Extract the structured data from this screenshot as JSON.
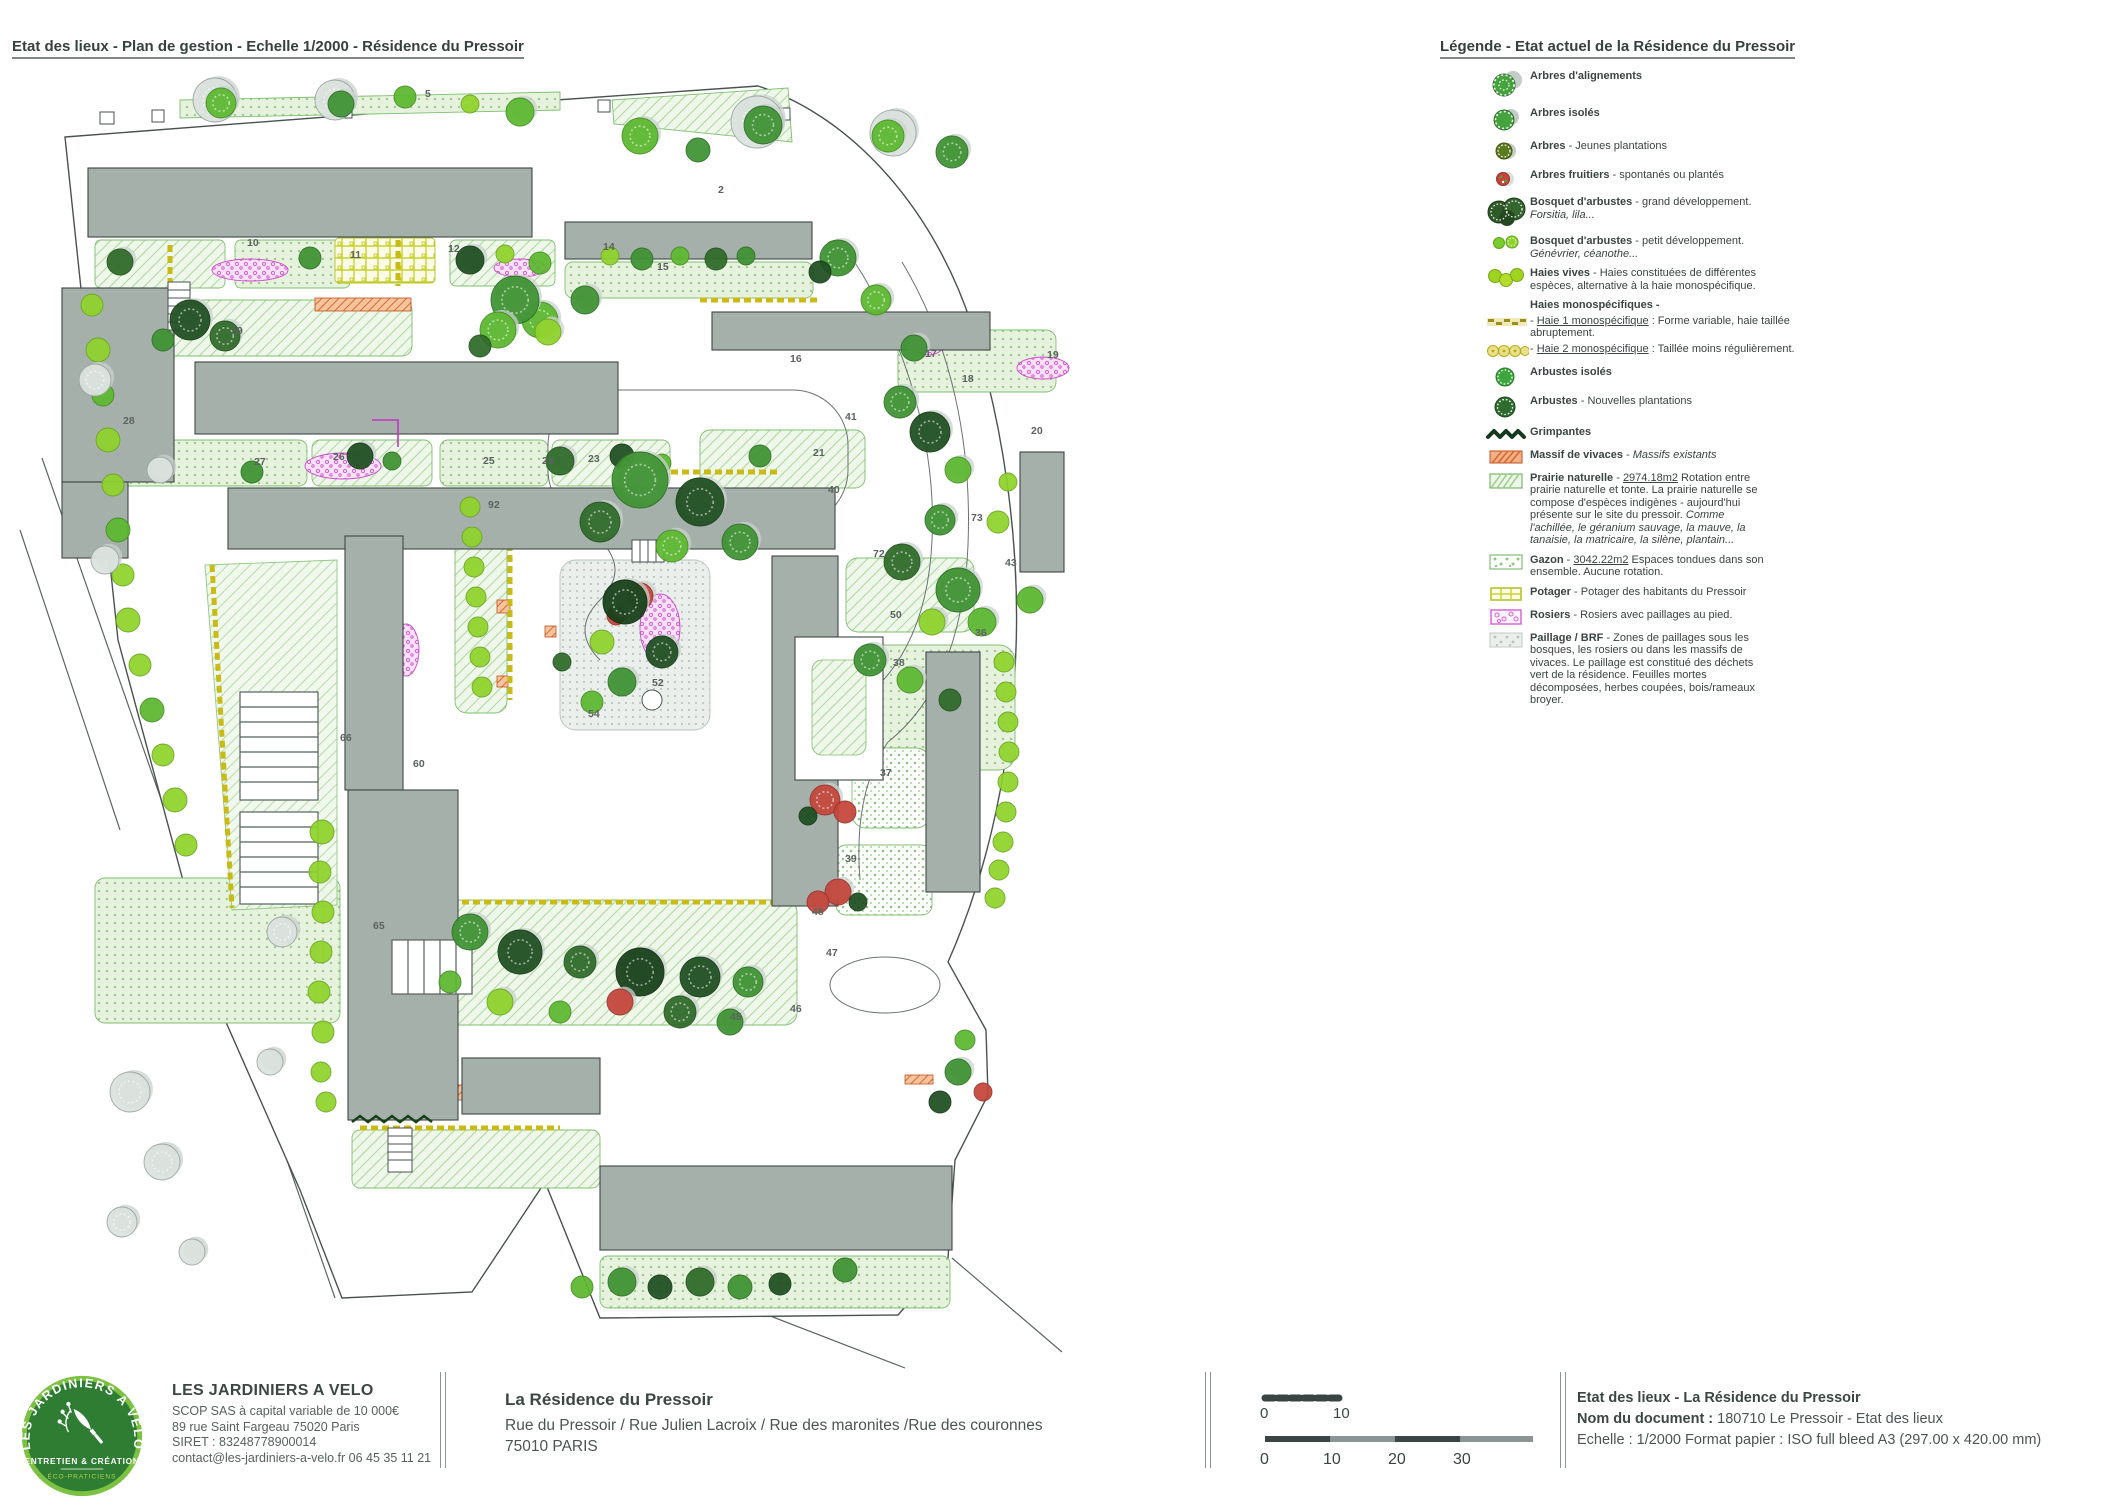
{
  "header": {
    "plan_title": "Etat des lieux - Plan de gestion - Echelle 1/2000 - Résidence du Pressoir",
    "legend_title": "Légende - Etat actuel de la Résidence du Pressoir"
  },
  "legend": {
    "items": [
      {
        "icon": "tree-alignment-icon",
        "lines": [
          [
            {
              "t": "Arbres d'alignements",
              "b": 1
            }
          ]
        ]
      },
      {
        "icon": "tree-isolated-icon",
        "lines": [
          [
            {
              "t": "Arbres isolés",
              "b": 1
            }
          ]
        ]
      },
      {
        "icon": "tree-young-icon",
        "lines": [
          [
            {
              "t": "Arbres",
              "b": 1
            },
            {
              "t": " - Jeunes plantations"
            }
          ]
        ]
      },
      {
        "icon": "tree-fruit-icon",
        "lines": [
          [
            {
              "t": "Arbres fruitiers",
              "b": 1
            },
            {
              "t": " - spontanés ou plantés"
            }
          ]
        ]
      },
      {
        "icon": "shrub-large-icon",
        "lines": [
          [
            {
              "t": "Bosquet d'arbustes",
              "b": 1
            },
            {
              "t": " - grand développement."
            }
          ],
          [
            {
              "t": "Forsitia, lila...",
              "i": 1
            }
          ]
        ]
      },
      {
        "icon": "shrub-small-icon",
        "lines": [
          [
            {
              "t": "Bosquet d'arbustes",
              "b": 1
            },
            {
              "t": " - petit développement."
            }
          ],
          [
            {
              "t": "Génévrier, céanothe...",
              "i": 1
            }
          ]
        ]
      },
      {
        "icon": "hedge-mixed-icon",
        "lines": [
          [
            {
              "t": "Haies vives",
              "b": 1
            },
            {
              "t": " - Haies constituées de différentes"
            }
          ],
          [
            {
              "t": "espèces, alternative à la haie monospécifique."
            }
          ]
        ]
      },
      {
        "icon": null,
        "tight": 1,
        "lines": [
          [
            {
              "t": "Haies monospécifiques -",
              "b": 1
            }
          ]
        ]
      },
      {
        "icon": "hedge-mono1-icon",
        "tight": 1,
        "lines": [
          [
            {
              "t": "- "
            },
            {
              "t": "Haie 1 monospécifique",
              "u": 1
            },
            {
              "t": " : Forme variable, haie taillée"
            }
          ],
          [
            {
              "t": "abruptement."
            }
          ]
        ]
      },
      {
        "icon": "hedge-mono2-icon",
        "lines": [
          [
            {
              "t": "- "
            },
            {
              "t": "Haie 2 monospécifique",
              "u": 1
            },
            {
              "t": " : Taillée moins régulièrement."
            }
          ]
        ]
      },
      {
        "icon": "arbuste-isolated-icon",
        "lines": [
          [
            {
              "t": "Arbustes isolés",
              "b": 1
            }
          ]
        ]
      },
      {
        "icon": "arbuste-new-icon",
        "lines": [
          [
            {
              "t": "Arbustes",
              "b": 1
            },
            {
              "t": " - Nouvelles plantations"
            }
          ]
        ]
      },
      {
        "icon": "climber-icon",
        "lines": [
          [
            {
              "t": "Grimpantes",
              "b": 1
            }
          ]
        ]
      },
      {
        "icon": "perennial-icon",
        "lines": [
          [
            {
              "t": "Massif de vivaces",
              "b": 1
            },
            {
              "t": " - "
            },
            {
              "t": "Massifs existants",
              "i": 1
            }
          ]
        ]
      },
      {
        "icon": "prairie-icon",
        "lines": [
          [
            {
              "t": "Prairie naturelle",
              "b": 1
            },
            {
              "t": " - "
            },
            {
              "t": "2974.18m2",
              "u": 1
            },
            {
              "t": " Rotation entre"
            }
          ],
          [
            {
              "t": "prairie naturelle et tonte. La prairie naturelle se"
            }
          ],
          [
            {
              "t": "compose d'espèces indigènes - aujourd'hui"
            }
          ],
          [
            {
              "t": "présente sur le site du pressoir. "
            },
            {
              "t": "Comme",
              "i": 1
            }
          ],
          [
            {
              "t": "l'achillée, le géranium sauvage, la mauve, la",
              "i": 1
            }
          ],
          [
            {
              "t": "tanaisie, la matricaire, la silène, plantain...",
              "i": 1
            }
          ]
        ]
      },
      {
        "icon": "gazon-icon",
        "lines": [
          [
            {
              "t": "Gazon",
              "b": 1
            },
            {
              "t": " - "
            },
            {
              "t": "3042.22m2",
              "u": 1
            },
            {
              "t": " Espaces tondues dans son"
            }
          ],
          [
            {
              "t": "ensemble. Aucune rotation."
            }
          ]
        ]
      },
      {
        "icon": "potager-icon",
        "lines": [
          [
            {
              "t": "Potager",
              "b": 1
            },
            {
              "t": " - Potager des habitants du Pressoir"
            }
          ]
        ]
      },
      {
        "icon": "rosiers-icon",
        "lines": [
          [
            {
              "t": "Rosiers",
              "b": 1
            },
            {
              "t": " - Rosiers avec paillages au pied."
            }
          ]
        ]
      },
      {
        "icon": "paillage-icon",
        "lines": [
          [
            {
              "t": "Paillage / BRF",
              "b": 1
            },
            {
              "t": " - Zones de paillages sous les"
            }
          ],
          [
            {
              "t": "bosques, les rosiers ou dans les massifs de"
            }
          ],
          [
            {
              "t": "vivaces. Le paillage est  constitué des déchets"
            }
          ],
          [
            {
              "t": "vert de la résidence. Feuilles mortes"
            }
          ],
          [
            {
              "t": "décomposées, herbes coupées, bois/rameaux"
            }
          ],
          [
            {
              "t": "broyer."
            }
          ]
        ]
      }
    ]
  },
  "map": {
    "zone_labels": [
      {
        "n": "5",
        "x": 425,
        "y": 97
      },
      {
        "n": "2",
        "x": 718,
        "y": 193
      },
      {
        "n": "92",
        "x": 488,
        "y": 508
      },
      {
        "n": "10",
        "x": 247,
        "y": 246
      },
      {
        "n": "11",
        "x": 350,
        "y": 258
      },
      {
        "n": "12",
        "x": 448,
        "y": 252
      },
      {
        "n": "14",
        "x": 603,
        "y": 250
      },
      {
        "n": "15",
        "x": 657,
        "y": 270
      },
      {
        "n": "16",
        "x": 790,
        "y": 362
      },
      {
        "n": "17",
        "x": 925,
        "y": 357
      },
      {
        "n": "18",
        "x": 962,
        "y": 382
      },
      {
        "n": "19",
        "x": 1047,
        "y": 358
      },
      {
        "n": "20",
        "x": 1031,
        "y": 434
      },
      {
        "n": "21",
        "x": 813,
        "y": 456
      },
      {
        "n": "23",
        "x": 588,
        "y": 462
      },
      {
        "n": "24",
        "x": 542,
        "y": 464
      },
      {
        "n": "25",
        "x": 483,
        "y": 464
      },
      {
        "n": "26",
        "x": 333,
        "y": 460
      },
      {
        "n": "27",
        "x": 254,
        "y": 465
      },
      {
        "n": "28",
        "x": 123,
        "y": 424
      },
      {
        "n": "29",
        "x": 231,
        "y": 334
      },
      {
        "n": "36",
        "x": 975,
        "y": 636
      },
      {
        "n": "37",
        "x": 880,
        "y": 776
      },
      {
        "n": "38",
        "x": 893,
        "y": 666
      },
      {
        "n": "39",
        "x": 845,
        "y": 862
      },
      {
        "n": "40",
        "x": 828,
        "y": 493
      },
      {
        "n": "41",
        "x": 845,
        "y": 420
      },
      {
        "n": "43",
        "x": 1005,
        "y": 566
      },
      {
        "n": "45",
        "x": 730,
        "y": 1020
      },
      {
        "n": "46",
        "x": 790,
        "y": 1012
      },
      {
        "n": "47",
        "x": 826,
        "y": 956
      },
      {
        "n": "48",
        "x": 812,
        "y": 915
      },
      {
        "n": "50",
        "x": 890,
        "y": 618
      },
      {
        "n": "52",
        "x": 652,
        "y": 686
      },
      {
        "n": "54",
        "x": 588,
        "y": 717
      },
      {
        "n": "60",
        "x": 413,
        "y": 767
      },
      {
        "n": "65",
        "x": 373,
        "y": 929
      },
      {
        "n": "66",
        "x": 340,
        "y": 741
      },
      {
        "n": "72",
        "x": 873,
        "y": 557
      },
      {
        "n": "73",
        "x": 971,
        "y": 521
      }
    ]
  },
  "footer": {
    "logo": {
      "arc_text": "LES JARDINIERS A VÉLO",
      "band": "ENTRETIEN & CRÉATION",
      "sub": "ÉCO-PRATICIENS"
    },
    "company": {
      "name": "LES JARDINIERS A VELO",
      "lines": [
        "SCOP SAS à capital variable de 10 000€",
        "89 rue Saint Fargeau 75020 Paris",
        "SIRET : 83248778900014",
        "contact@les-jardiniers-a-velo.fr   06 45 35 11 21"
      ]
    },
    "project": {
      "title": "La Résidence du Pressoir",
      "address": "Rue du Pressoir / Rue Julien Lacroix / Rue des maronites /Rue des couronnes",
      "city": "75010 PARIS"
    },
    "scalebar": {
      "bar1_labels": [
        "0",
        "10"
      ],
      "bar2_labels": [
        "0",
        "10",
        "20",
        "30"
      ]
    },
    "docinfo": {
      "title": "Etat des lieux - La Résidence du Pressoir",
      "doc_label": "Nom du document :",
      "doc_value": " 180710 Le Pressoir - Etat des lieux",
      "scale_line": "Echelle : 1/2000  Format papier : ISO full bleed A3 (297.00 x 420.00 mm)"
    }
  },
  "colors": {
    "building": "#a6b0ab",
    "boundary": "#4a5250",
    "prairie": "#eff7ea",
    "prairie_hatch": "#a9d89a",
    "tree_bright": "#8fd32b",
    "tree_dark": "#1f4e20",
    "rosier": "#e47fe0",
    "massif": "#e07038",
    "haie_yellow": "#c9ba16",
    "logo_green": "#2e7d32",
    "logo_ring": "#7cc142"
  }
}
